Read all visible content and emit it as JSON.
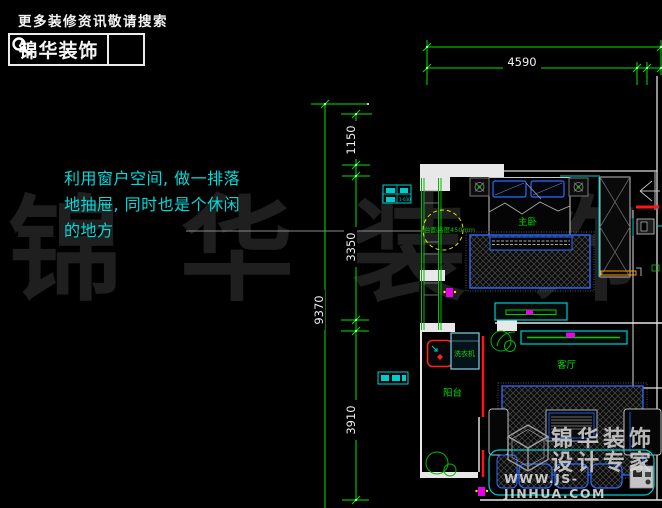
{
  "header": {
    "tagline": "更多装修资讯敬请搜索",
    "brand": "锦华装饰",
    "search_icon": "magnifier"
  },
  "annotation": {
    "note": "利用窗户空间, 做一排落\n地抽屉, 同时也是个休闲\n的地方"
  },
  "dimensions": {
    "top_width": "4590",
    "left": [
      "1150",
      "3350",
      "9370",
      "3910"
    ]
  },
  "plan_labels": {
    "counter_height_note": "台面高度450mm",
    "master_bedroom": "主卧",
    "living_room": "客厅",
    "balcony": "阳台",
    "washing_machine": "洗衣机",
    "switch_code": "1-030"
  },
  "watermarks": {
    "big_text": "锦华装饰",
    "logo_line1": "锦华装饰",
    "logo_line2": "设计专家",
    "logo_url": "WWW.JS-JINHUA.COM"
  },
  "colors": {
    "background": "#000000",
    "dimension_green": "#00e500",
    "annotation_cyan": "#00dcdc",
    "plan_cyan": "#00cccc",
    "furniture_blue": "#2b6bff",
    "alert_red": "#ff1515",
    "accent_orange": "#ff9900",
    "accent_magenta": "#e800e8",
    "callout_yellow": "#e6e600",
    "label_green": "#00cc00"
  }
}
